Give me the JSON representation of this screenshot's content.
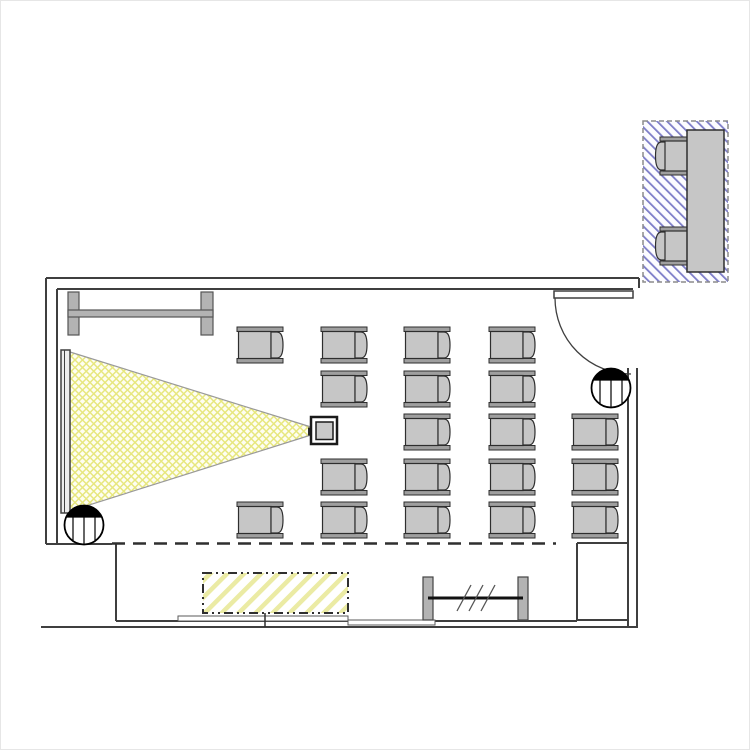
{
  "meta": {
    "document_type": "architectural-floor-plan",
    "description": "Seminar / classroom floor plan with projector beam cone, projection screen, tablet-arm chair grid, door swing, structural columns, bottom window wall and a furniture detail inset on blue hatching",
    "seat_count": 19,
    "inset_seat_count": 2
  },
  "canvas": {
    "width": 750,
    "height": 750
  },
  "palette": {
    "line": "#3f3f3f",
    "line_dark": "#1a1a1a",
    "line_soft": "#8c8c8c",
    "chair_fill": "#c6c6c6",
    "chair_bar_fill": "#9f9f9f",
    "chair_outline": "#2e2e2e",
    "rack_fill": "#b3b3b3",
    "screen_fill": "#ececec",
    "cone_bg": "#fefef2",
    "cone_line": "#e7e77e",
    "cone_border": "#9a9a9a",
    "stripe_yellow": "#ebeba4",
    "stripe_blue": "#7d7dc8",
    "inset_bg": "#fcfcff",
    "white": "#ffffff",
    "black": "#000000"
  },
  "plan": {
    "walls": {
      "stroke_width": 2,
      "segments": [
        [
          46,
          278,
          639,
          278
        ],
        [
          639,
          278,
          639,
          288
        ],
        [
          57,
          289,
          633,
          289
        ],
        [
          46,
          278,
          46,
          544
        ],
        [
          57,
          289,
          57,
          544
        ],
        [
          46,
          544,
          112,
          544
        ],
        [
          577,
          543,
          628,
          543
        ],
        [
          577,
          543,
          577,
          620
        ],
        [
          116,
          544,
          116,
          621
        ],
        [
          116,
          621,
          577,
          621
        ],
        [
          577,
          620,
          628,
          620
        ],
        [
          628,
          368,
          628,
          627
        ],
        [
          637,
          368,
          637,
          627
        ],
        [
          41,
          627,
          638,
          627
        ]
      ]
    },
    "dashed_boundary": {
      "x1": 112,
      "y1": 543.5,
      "x2": 556,
      "y2": 543.5,
      "dash": "13 8",
      "width": 2.5
    },
    "door": {
      "leaf": [
        554,
        291,
        79,
        7
      ],
      "swing": {
        "cx": 631,
        "cy": 298,
        "r": 76
      }
    },
    "screen": {
      "rect": [
        61,
        350,
        9,
        163
      ],
      "divider_x": 64.5
    },
    "cone": {
      "points": "70,352 311,427 311,435 70,511"
    },
    "projector": {
      "body": [
        311,
        417,
        26,
        27
      ],
      "inner": [
        316,
        422,
        17,
        17.5
      ],
      "lens": [
        308,
        427.5,
        5.5,
        8
      ]
    },
    "rack": {
      "posts": [
        [
          68,
          292,
          11,
          43
        ],
        [
          201,
          292,
          12,
          43
        ]
      ],
      "bar": [
        68,
        310,
        145,
        7
      ]
    },
    "columns": {
      "r": 19.5,
      "chord_dy": -8,
      "centers": [
        [
          611,
          388
        ],
        [
          84,
          525
        ]
      ]
    },
    "seating": {
      "size": [
        46,
        36
      ],
      "facing": "left",
      "positions": [
        [
          237,
          327
        ],
        [
          237,
          502
        ],
        [
          321,
          327
        ],
        [
          321,
          371
        ],
        [
          321,
          459
        ],
        [
          321,
          502
        ],
        [
          404,
          327
        ],
        [
          404,
          371
        ],
        [
          404,
          414
        ],
        [
          404,
          459
        ],
        [
          404,
          502
        ],
        [
          489,
          327
        ],
        [
          489,
          371
        ],
        [
          489,
          414
        ],
        [
          489,
          459
        ],
        [
          489,
          502
        ],
        [
          572,
          414
        ],
        [
          572,
          459
        ],
        [
          572,
          502
        ]
      ]
    },
    "windows": {
      "sills": [
        [
          178,
          616,
          87,
          5
        ],
        [
          265,
          616,
          83,
          5
        ],
        [
          348,
          620,
          87,
          5
        ]
      ]
    },
    "floor_hatch": {
      "rect": [
        203,
        573,
        145,
        40
      ],
      "border_dash": "9 4 2 4 2 4",
      "tick": [
        265,
        613,
        265,
        627
      ]
    },
    "radiator": {
      "legs": [
        [
          423,
          577,
          10,
          43
        ],
        [
          518,
          577,
          10,
          43
        ]
      ],
      "bar": [
        428,
        598,
        523,
        598
      ],
      "ticks": [
        [
          457,
          611,
          471,
          585
        ],
        [
          469,
          611,
          483,
          585
        ],
        [
          481,
          611,
          495,
          585
        ]
      ]
    },
    "inset": {
      "frame": [
        643,
        121,
        85,
        161
      ],
      "frame_dash": "5 3",
      "table": [
        687,
        130,
        37,
        142
      ],
      "chair_size": [
        33,
        38
      ],
      "chair_facing": "right",
      "chairs": [
        [
          655,
          137
        ],
        [
          655,
          227
        ]
      ]
    }
  }
}
